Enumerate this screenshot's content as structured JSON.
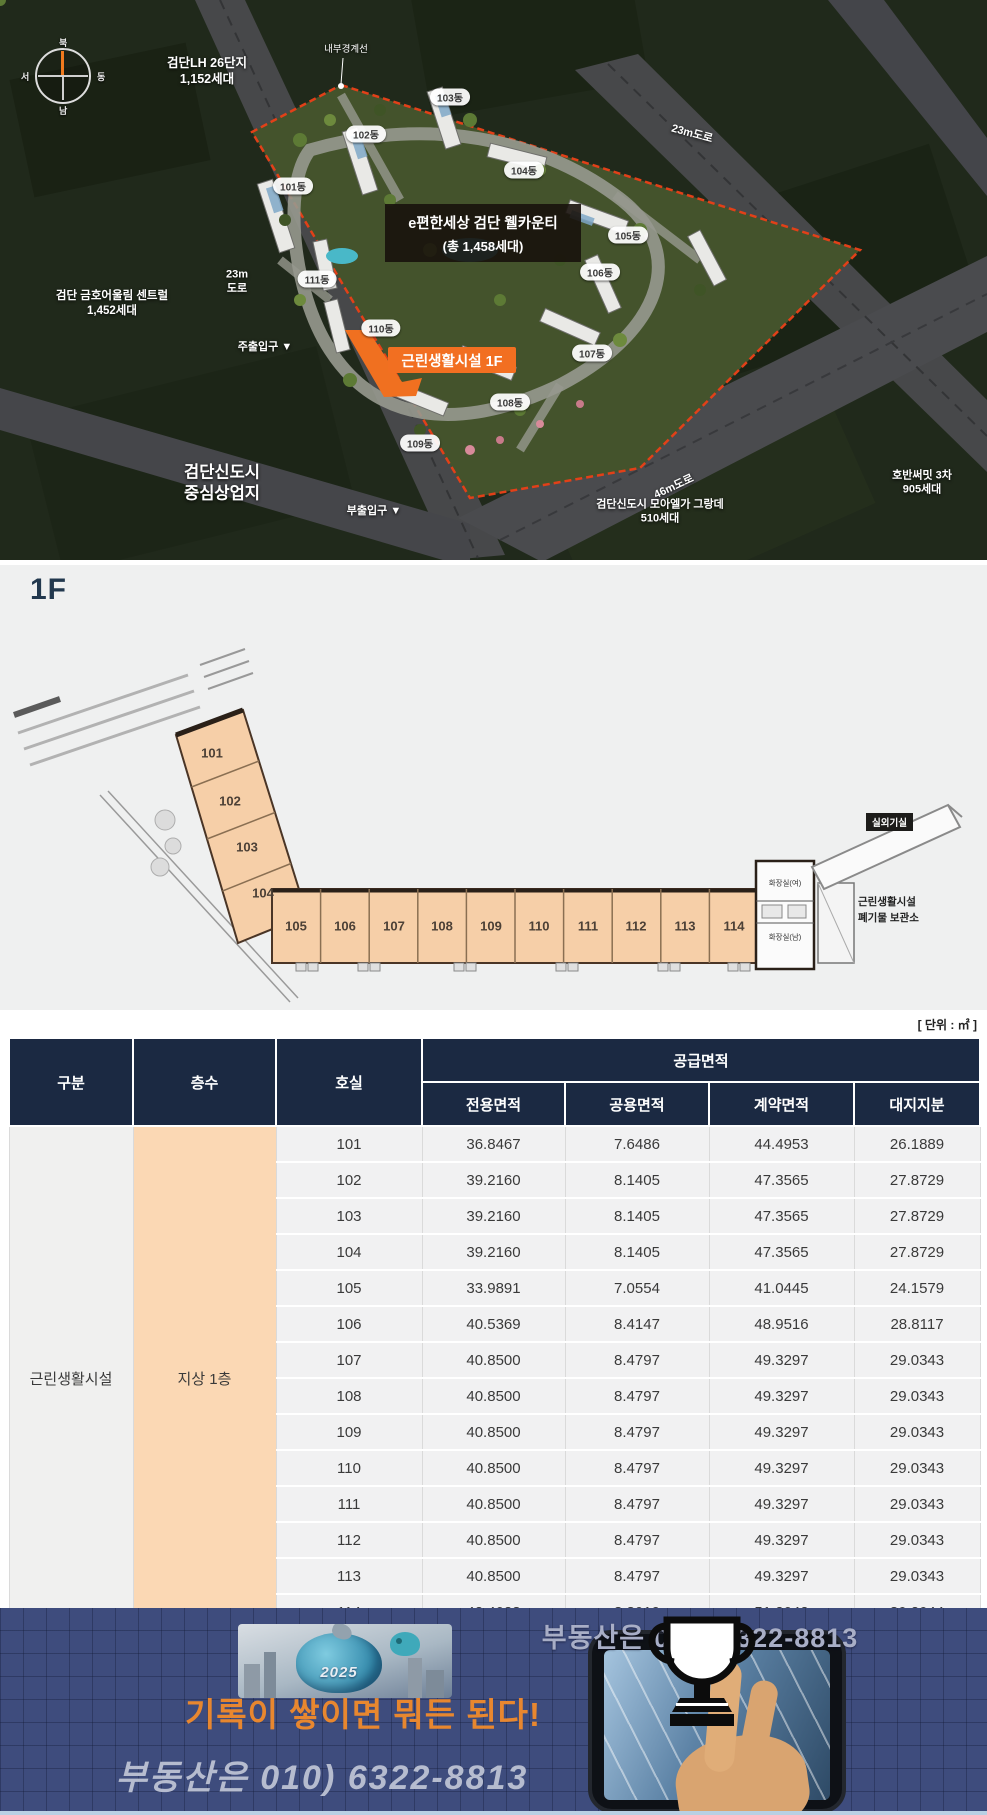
{
  "aerial": {
    "compass": {
      "n": "북",
      "e": "동",
      "s": "남",
      "w": "서"
    },
    "labels": {
      "lh1": "검단LH 26단지",
      "lh2": "1,152세대",
      "boundary": "내부경계선",
      "road23_right": "23m도로",
      "road23_left1": "23m",
      "road23_left2": "도로",
      "main_entrance": "주출입구 ▼",
      "kumho1": "검단 금호어울림 센트럴",
      "kumho2": "1,452세대",
      "newtown1": "검단신도시",
      "newtown2": "중심상업지",
      "sub_entrance": "부출입구 ▼",
      "road46": "46m도로",
      "moa1": "검단신도시 모아엘가 그랑데",
      "moa2": "510세대",
      "hoban1": "호반써밋 3차",
      "hoban2": "905세대",
      "title1": "e편한세상 검단 웰카운티",
      "title2": "(총 1,458세대)",
      "callout": "근린생활시설 1F"
    },
    "buildings": [
      "101동",
      "102동",
      "103동",
      "104동",
      "105동",
      "106동",
      "107동",
      "108동",
      "109동",
      "110동",
      "111동"
    ]
  },
  "floorplan": {
    "title": "1F",
    "units_diagonal": [
      "101",
      "102",
      "103",
      "104"
    ],
    "units_row": [
      "105",
      "106",
      "107",
      "108",
      "109",
      "110",
      "111",
      "112",
      "113",
      "114"
    ],
    "labels": {
      "restroom_f": "화장실(여)",
      "restroom_m": "화장실(남)",
      "outdoor_unit": "실외기실",
      "waste1": "근린생활시설",
      "waste2": "폐기물 보관소"
    }
  },
  "table": {
    "unit_note": "[ 단위 : ㎡ ]",
    "headers": {
      "category": "구분",
      "floor": "층수",
      "room": "호실",
      "supply": "공급면적",
      "exclusive": "전용면적",
      "common": "공용면적",
      "contract": "계약면적",
      "land": "대지지분"
    },
    "category": "근린생활시설",
    "floor_value": "지상 1층",
    "rows": [
      {
        "room": "101",
        "exclusive": "36.8467",
        "common": "7.6486",
        "contract": "44.4953",
        "land": "26.1889"
      },
      {
        "room": "102",
        "exclusive": "39.2160",
        "common": "8.1405",
        "contract": "47.3565",
        "land": "27.8729"
      },
      {
        "room": "103",
        "exclusive": "39.2160",
        "common": "8.1405",
        "contract": "47.3565",
        "land": "27.8729"
      },
      {
        "room": "104",
        "exclusive": "39.2160",
        "common": "8.1405",
        "contract": "47.3565",
        "land": "27.8729"
      },
      {
        "room": "105",
        "exclusive": "33.9891",
        "common": "7.0554",
        "contract": "41.0445",
        "land": "24.1579"
      },
      {
        "room": "106",
        "exclusive": "40.5369",
        "common": "8.4147",
        "contract": "48.9516",
        "land": "28.8117"
      },
      {
        "room": "107",
        "exclusive": "40.8500",
        "common": "8.4797",
        "contract": "49.3297",
        "land": "29.0343"
      },
      {
        "room": "108",
        "exclusive": "40.8500",
        "common": "8.4797",
        "contract": "49.3297",
        "land": "29.0343"
      },
      {
        "room": "109",
        "exclusive": "40.8500",
        "common": "8.4797",
        "contract": "49.3297",
        "land": "29.0343"
      },
      {
        "room": "110",
        "exclusive": "40.8500",
        "common": "8.4797",
        "contract": "49.3297",
        "land": "29.0343"
      },
      {
        "room": "111",
        "exclusive": "40.8500",
        "common": "8.4797",
        "contract": "49.3297",
        "land": "29.0343"
      },
      {
        "room": "112",
        "exclusive": "40.8500",
        "common": "8.4797",
        "contract": "49.3297",
        "land": "29.0343"
      },
      {
        "room": "113",
        "exclusive": "40.8500",
        "common": "8.4797",
        "contract": "49.3297",
        "land": "29.0343"
      },
      {
        "room": "114",
        "exclusive": "42.4023",
        "common": "8.8019",
        "contract": "51.2042",
        "land": "30.2044"
      }
    ]
  },
  "footer": {
    "phone_top": "부동산은 010) 6322-8813",
    "slogan": "기록이 쌓이면 뭐든 된다!",
    "phone_bottom": "부동산은 010)  6322-8813",
    "bag_year": "2025",
    "colors": {
      "accent_orange": "#f26f21",
      "header_navy": "#1b2942",
      "banner_navy": "#3e4c7d",
      "peach": "#fbd8b4"
    }
  }
}
